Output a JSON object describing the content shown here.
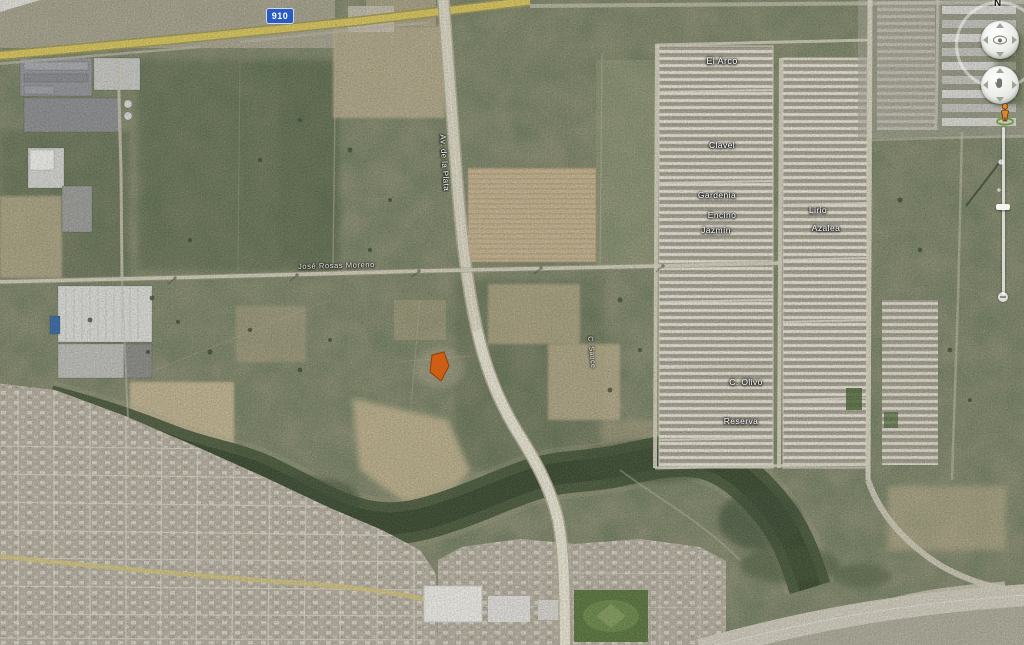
{
  "view": {
    "type": "satellite-imagery",
    "app_style": "google-earth"
  },
  "map": {
    "highway_shield": {
      "number": "910"
    },
    "road_labels": {
      "avenue": "Av. de la Plata",
      "cross_road": "José Rosas Moreno"
    },
    "street_labels": [
      "El Arco",
      "Clavel",
      "Gardenia",
      "Encino",
      "Jazmín",
      "Lirio",
      "Azalea",
      "C. Olivo",
      "Reserva",
      "C. Sauce"
    ],
    "marker": {
      "name": "highlighted-parcel",
      "color": "#d35c10"
    }
  },
  "navigation": {
    "north_label": "N",
    "icons": {
      "look": "eye-icon",
      "move": "hand-icon",
      "street_view": "pegman-icon",
      "zoom": "zoom-slider"
    }
  },
  "colors": {
    "highway_shield_bg": "#2a5bc0",
    "main_road_yellow": "#d6c45f",
    "parcel_orange": "#d35c10",
    "scrub_base": "#8a8d72"
  }
}
